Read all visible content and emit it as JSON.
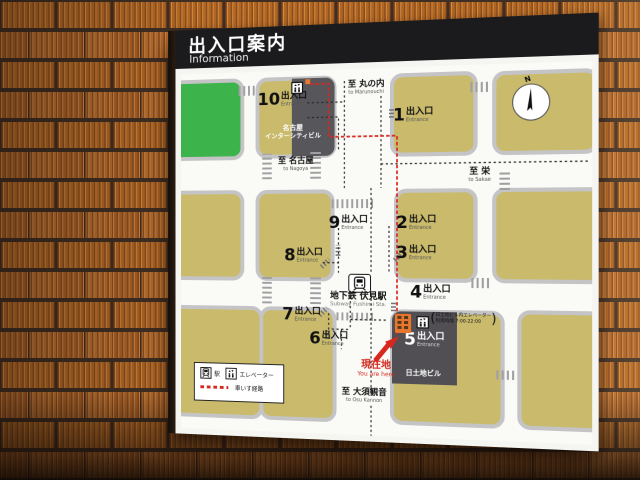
{
  "header": {
    "title_ja": "出入口案内",
    "title_en": "Information"
  },
  "map": {
    "exit_word": "出入口",
    "entrance_word": "Entrance",
    "exit_numbers": {
      "x1": "1",
      "x2": "2",
      "x3": "3",
      "x4": "4",
      "x5": "5",
      "x6": "6",
      "x7": "7",
      "x8": "8",
      "x9": "9",
      "x10": "10"
    },
    "station": {
      "ja": "地下鉄 伏見駅",
      "en": "Subway Fushimi Sta."
    },
    "directions": {
      "marunouchi": {
        "ja": "至 丸の内",
        "en": "to Marunouchi"
      },
      "nagoya": {
        "ja": "至 名古屋",
        "en": "to Nagoya"
      },
      "sakae": {
        "ja": "至 栄",
        "en": "to Sakae"
      },
      "osukannon": {
        "ja": "至 大須観音",
        "en": "to Osu Kannon"
      }
    },
    "buildings": {
      "intercity_l1": "名古屋",
      "intercity_l2": "インターシティビル",
      "nittochi": "日土地ビル"
    },
    "you_are_here": {
      "ja": "現在地",
      "en": "You are here"
    },
    "elevator_note": {
      "open": "(",
      "line1": "日土地ビル内エレベーター",
      "line2": "利用時間 7:00-22:00",
      "close": ")"
    },
    "compass_label": "N",
    "legend": {
      "station": "駅",
      "elevator": "エレベーター",
      "wheelchair": "車いす経路"
    },
    "colors": {
      "block": "#c9ba6c",
      "park": "#3cb34b",
      "building_dark": "#56565b",
      "route_red": "#d7281f",
      "accent_orange": "#e8762c",
      "header_bg": "#1b1b1d"
    }
  }
}
